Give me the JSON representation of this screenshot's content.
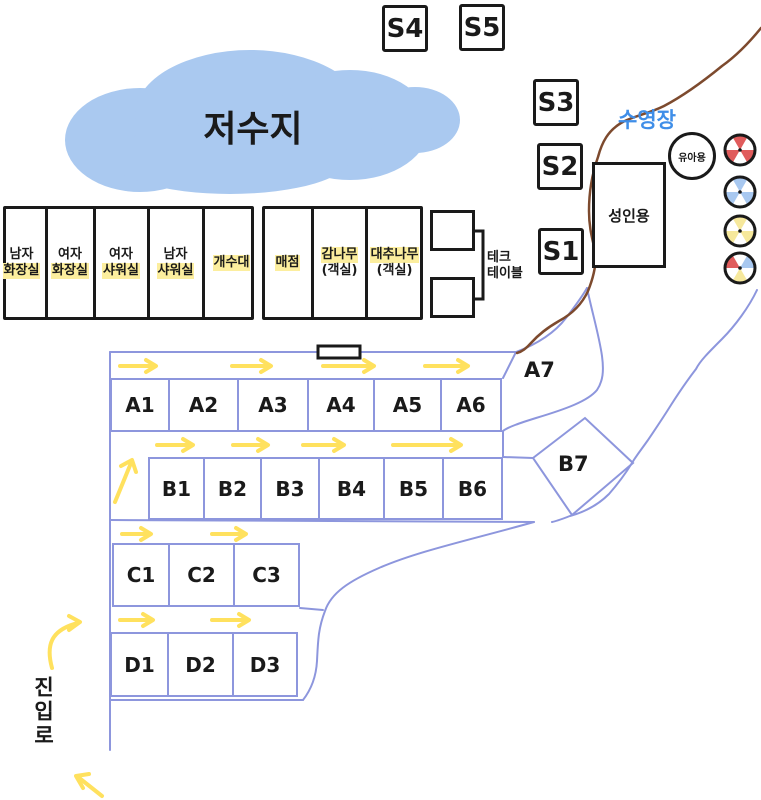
{
  "reservoir": {
    "label": "저수지"
  },
  "pool": {
    "area_label": "수영장",
    "kids_pool_label": "유아용",
    "adult_pool_label": "성인용"
  },
  "s_sites": [
    "S4",
    "S5",
    "S3",
    "S2",
    "S1"
  ],
  "buildings": {
    "block1": [
      {
        "line1": "남자",
        "line2": "화장실"
      },
      {
        "line1": "여자",
        "line2": "화장실"
      },
      {
        "line1": "여자",
        "line2": "샤워실"
      },
      {
        "line1": "남자",
        "line2": "샤워실"
      },
      {
        "line1": "개수대"
      }
    ],
    "block2": [
      {
        "line1": "매점"
      },
      {
        "line1": "감나무",
        "line2": "(객실)"
      },
      {
        "line1": "대추나무",
        "line2": "(객실)"
      }
    ],
    "deck_table": {
      "line1": "테크",
      "line2": "테이블"
    }
  },
  "sites": {
    "a": [
      "A1",
      "A2",
      "A3",
      "A4",
      "A5",
      "A6"
    ],
    "a7": "A7",
    "b": [
      "B1",
      "B2",
      "B3",
      "B4",
      "B5",
      "B6"
    ],
    "b7": "B7",
    "c": [
      "C1",
      "C2",
      "C3"
    ],
    "d": [
      "D1",
      "D2",
      "D3"
    ]
  },
  "entrance": {
    "label": "진입로"
  },
  "beach_balls": [
    "red/white",
    "blue/white",
    "yellow/white",
    "red/blue/yellow"
  ],
  "colors": {
    "reservoir_fill": "#aac9f0",
    "road_line": "#8d96dd",
    "path_brown": "#7d4a2e",
    "arrow_yellow": "#ffe15e",
    "highlight_yellow": "#fcee9e",
    "pool_text_blue": "#3f8ee8",
    "ball_red": "#e05c5c",
    "ball_blue": "#a8c8f0",
    "ball_yellow": "#f6e89c",
    "ink_black": "#1a1a1a"
  }
}
